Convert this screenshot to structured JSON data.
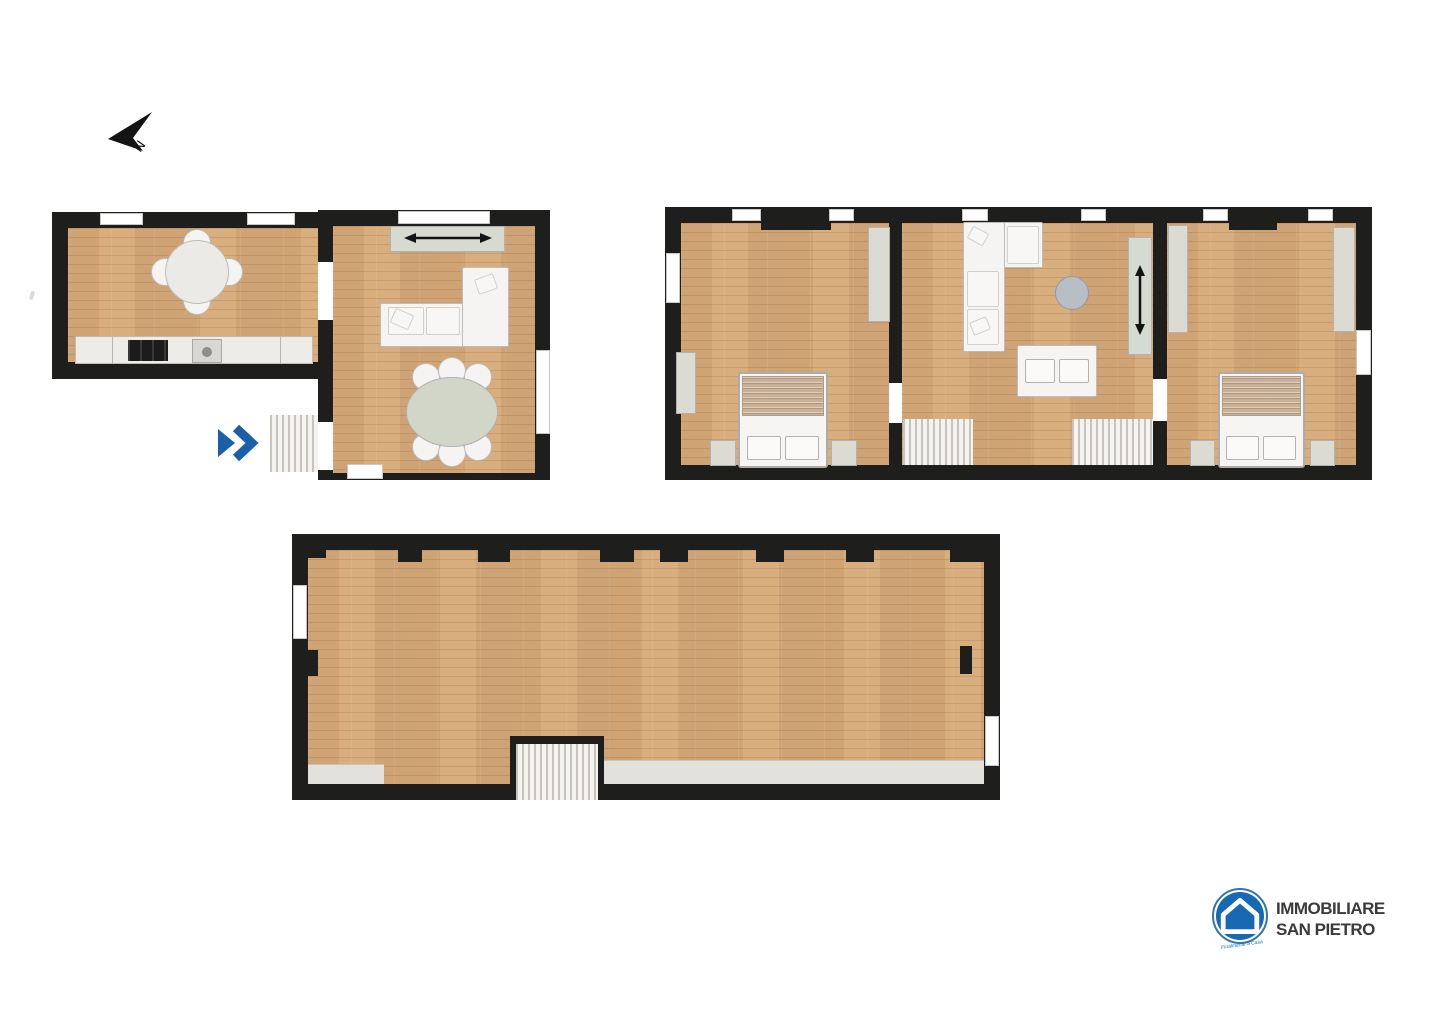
{
  "compass": {
    "label": "N",
    "icon": "north-arrow-icon"
  },
  "entrance": {
    "icon": "double-chevron-right-icon",
    "color": "#1a5fa8"
  },
  "palette": {
    "wall": "#1e1e1c",
    "wood_floor": "#d5aa7d",
    "furniture_gray": "#dbdad3",
    "furniture_white": "#f5f4f2",
    "counter_white": "#edece8",
    "stairs": "#f4f3f0",
    "accent_blue": "#1a5fa8",
    "logo_blue": "#1769b3",
    "low_ceiling_gray": "#e3e1db"
  },
  "floors": [
    {
      "name": "ground-floor",
      "rooms": [
        {
          "name": "kitchen",
          "furniture": [
            "round-dining-table",
            "four-chairs",
            "kitchen-counter",
            "cooktop",
            "sink"
          ]
        },
        {
          "name": "living-dining-room",
          "furniture": [
            "sideboard-with-sliding-doors",
            "corner-sofa",
            "oval-dining-table",
            "six-chairs"
          ]
        }
      ],
      "features": [
        "exterior-entrance-steps",
        "entrance-marker"
      ]
    },
    {
      "name": "first-floor",
      "rooms": [
        {
          "name": "bedroom-1",
          "furniture": [
            "double-bed",
            "two-nightstands",
            "wardrobe",
            "tall-wardrobe"
          ]
        },
        {
          "name": "living-area",
          "furniture": [
            "corner-sofa",
            "loveseat",
            "round-side-table",
            "wardrobe-with-sliding-doors"
          ],
          "features": [
            "staircase-left",
            "staircase-right"
          ]
        },
        {
          "name": "bedroom-2",
          "furniture": [
            "double-bed",
            "two-nightstands",
            "wardrobe-left",
            "wardrobe-right"
          ]
        }
      ]
    },
    {
      "name": "attic",
      "rooms": [
        {
          "name": "open-space",
          "furniture": [],
          "features": [
            "staircase",
            "low-ceiling-strip"
          ]
        }
      ]
    }
  ],
  "logo": {
    "line1": "IMMOBILIARE",
    "line2": "SAN PIETRO",
    "tagline": "Finalmente a Casa",
    "icon": "house-circle-logo"
  }
}
